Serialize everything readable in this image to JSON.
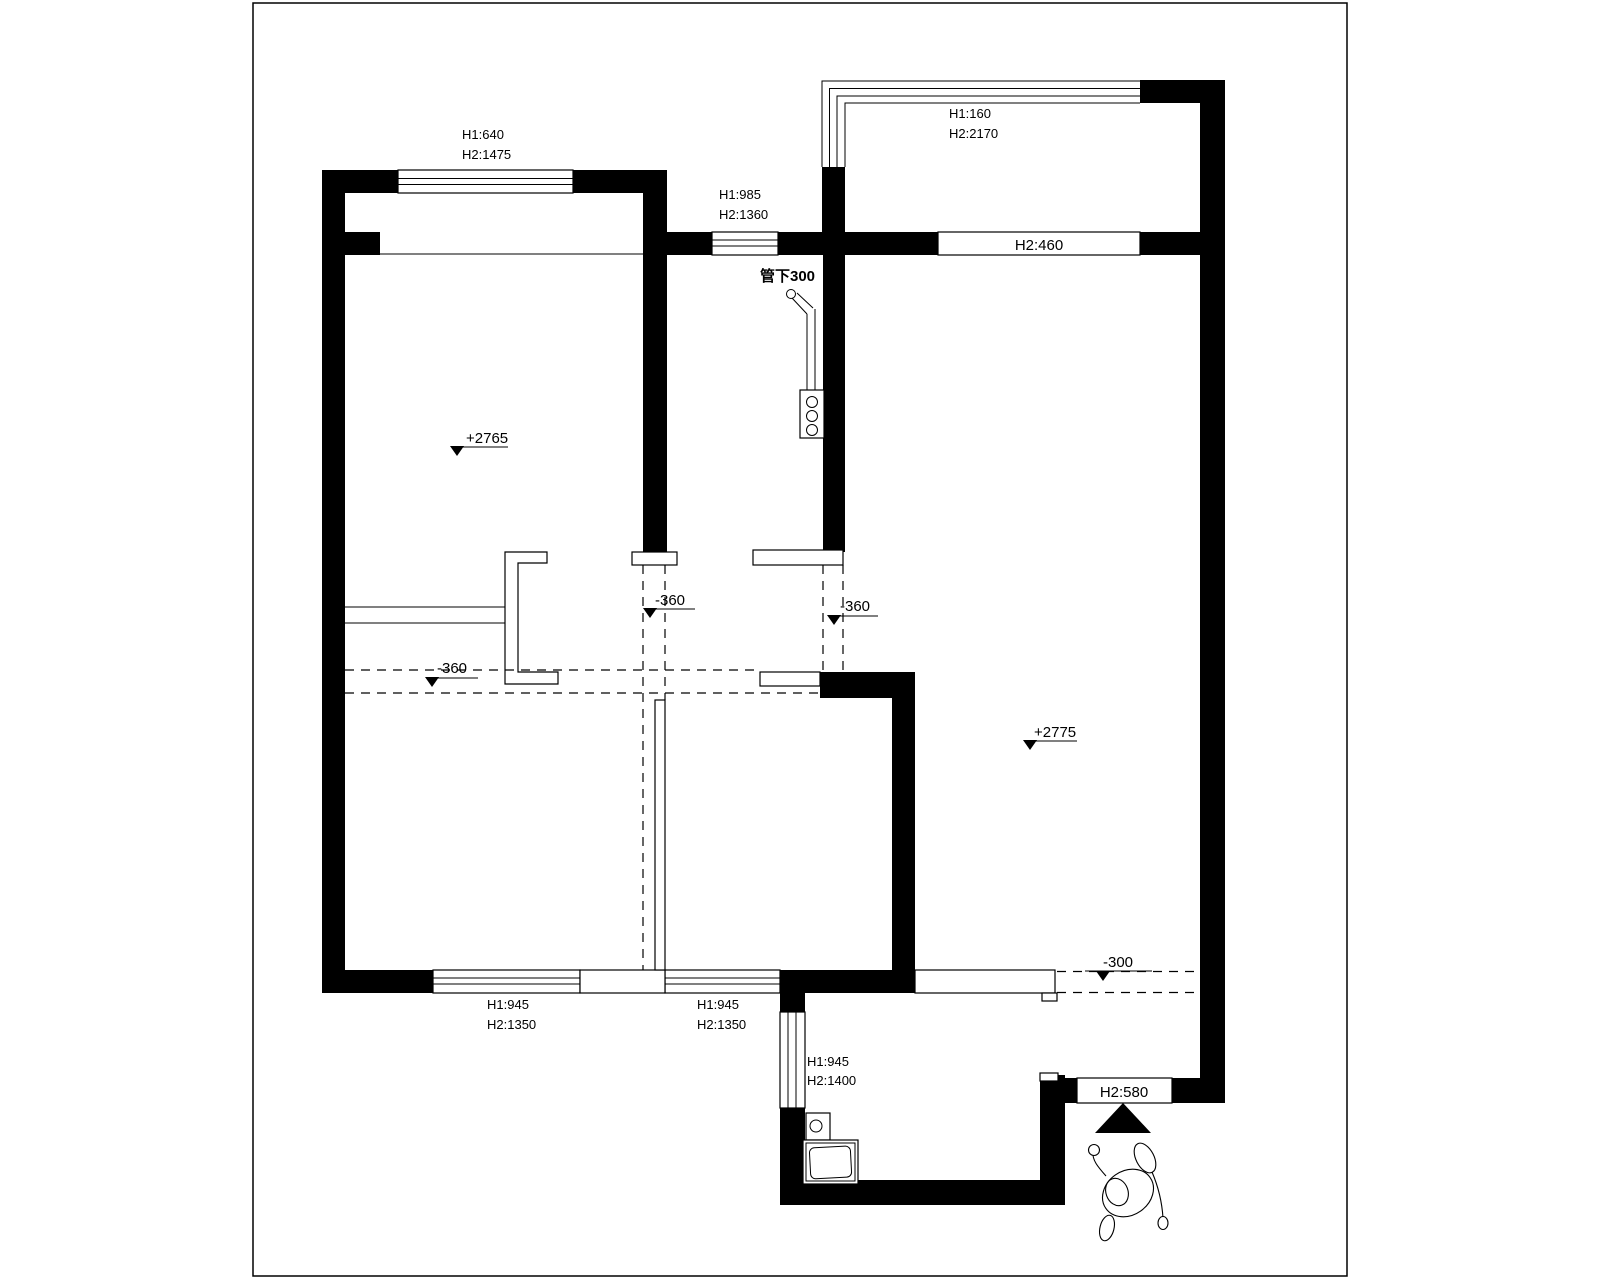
{
  "drawing": {
    "type": "residential floor plan (original structure / demolition plan)",
    "colors": {
      "ink": "#000000",
      "paper": "#ffffff"
    }
  },
  "labels": {
    "top_left_window": {
      "h1": "H1:640",
      "h2": "H2:1475"
    },
    "mid_top_window": {
      "h1": "H1:985",
      "h2": "H2:1360"
    },
    "balcony_window": {
      "h1": "H1:160",
      "h2": "H2:2170"
    },
    "right_wall_opening": "H2:460",
    "pipe_note": "管下300",
    "level_bedroom": "+2765",
    "level_living": "+2775",
    "floor_drop_left": "-360",
    "floor_drop_mid": "-360",
    "floor_drop_right": "-360",
    "floor_drop_entry": "-300",
    "bottom_left_window": {
      "h1": "H1:945",
      "h2": "H2:1350"
    },
    "bottom_mid_window": {
      "h1": "H1:945",
      "h2": "H2:1350"
    },
    "side_window": {
      "h1": "H1:945",
      "h2": "H2:1400"
    },
    "entry_opening": "H2:580"
  }
}
